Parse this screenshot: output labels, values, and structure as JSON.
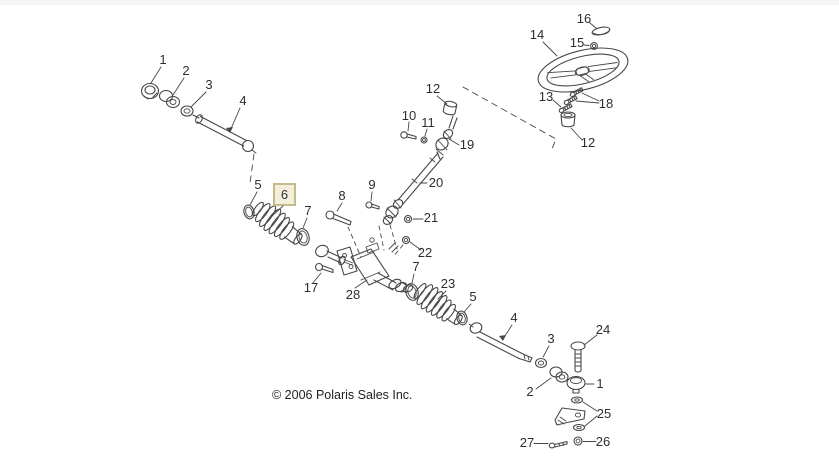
{
  "window": {
    "background": "#ffffff",
    "top_bar_color": "#f4f4f5"
  },
  "colors": {
    "line": "#474747",
    "label_text": "#2e2e2e",
    "highlight_fill": "#f4efdc",
    "highlight_border": "#c5ba8c",
    "copyright_text": "#1f1f1f",
    "top_bar": "#f4f4f5"
  },
  "footer": {
    "copyright": "© 2006 Polaris Sales Inc."
  },
  "callouts": {
    "tie_rod_end_upper": "1",
    "jam_nut_upper": "2",
    "nut_upper": "3",
    "tie_rod_upper": "4",
    "clamp_left": "5",
    "boot_left_highlighted": "6",
    "clamp_inner_left": "7",
    "bolt_8": "8",
    "bolt_9": "9",
    "bolt_10": "10",
    "nut_11": "11",
    "bushing_upper": "12",
    "screw_13": "13",
    "steering_wheel": "14",
    "nut_15": "15",
    "cap_16": "16",
    "bolt_17": "17",
    "screws_18": "18",
    "ujoint_19": "19",
    "shaft_20": "20",
    "nut_21": "21",
    "nut_22": "22",
    "boot_right": "23",
    "bolt_24": "24",
    "washers_25": "25",
    "nut_26": "26",
    "bolt_27": "27",
    "gear_28": "28",
    "bushing_lower": "12",
    "clamp_right_outer": "5",
    "clamp_inner_right": "7",
    "tie_rod_lower": "4",
    "nut_lower": "3",
    "jam_nut_lower": "2",
    "tie_rod_end_lower": "1"
  }
}
